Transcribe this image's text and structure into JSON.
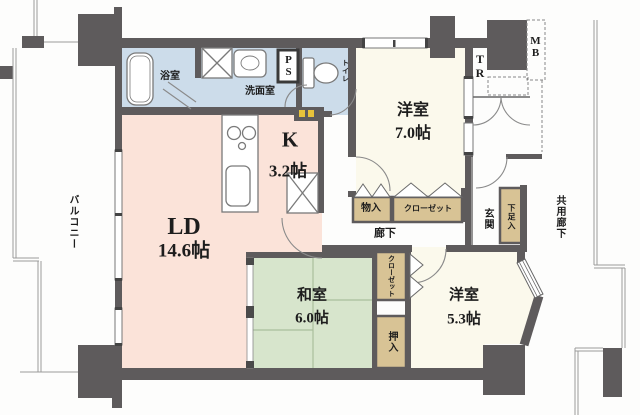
{
  "title": "マンション間取り図 (apartment floor plan)",
  "colors": {
    "wall": "#5e5b5c",
    "ldk_pink": "#fbe3d9",
    "tatami_green": "#d7e5cc",
    "western_cream": "#fbf9ec",
    "water_blue": "#ccdcea",
    "closet_tan": "#d8c395",
    "heater_yellow": "#e8c33a"
  },
  "rooms": {
    "ld": {
      "name": "LD",
      "size": "14.6帖"
    },
    "kitchen": {
      "name": "K",
      "size": "3.2帖"
    },
    "western7": {
      "name": "洋室",
      "size": "7.0帖"
    },
    "western5": {
      "name": "洋室",
      "size": "5.3帖"
    },
    "japanese": {
      "name": "和室",
      "size": "6.0帖"
    },
    "bath": {
      "name": "浴室"
    },
    "washroom": {
      "name": "洗面室"
    },
    "toilet": {
      "name": "トイレ"
    },
    "hallway": {
      "name": "廊下"
    },
    "entrance": {
      "name": "玄関"
    },
    "balcony": {
      "name": "バルコニー"
    },
    "common_corridor": {
      "name": "共用廊下"
    }
  },
  "storage": {
    "monoire": "物入",
    "closet_north": "クローゼット",
    "closet_side": "クローゼット",
    "oshiire": "押入",
    "getabako": "下足入"
  },
  "labels": {
    "ps": "PS",
    "tr": "TR",
    "mb": "MB"
  }
}
